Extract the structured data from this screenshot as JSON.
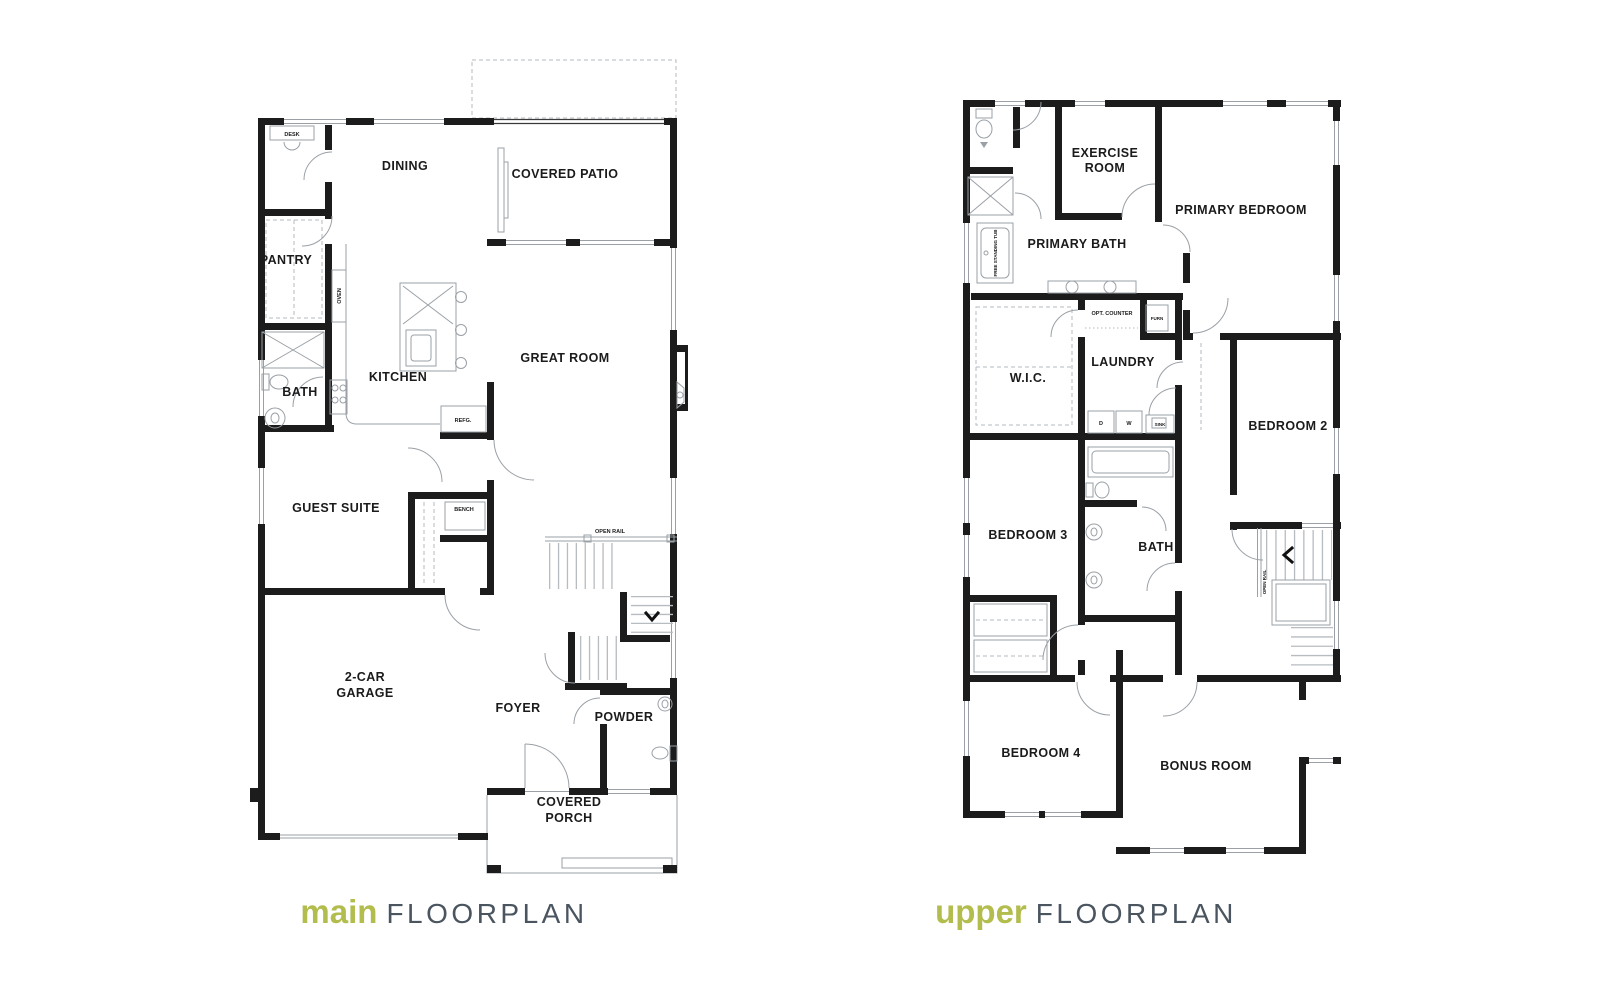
{
  "page": {
    "width": 1620,
    "height": 1000,
    "background": "#ffffff"
  },
  "colors": {
    "accent_green": "#b2bd4d",
    "title_gray": "#4a5560",
    "wall": "#1c1c1c",
    "fixture_gray": "#9aa0a6"
  },
  "titles": {
    "main": {
      "accent": "main",
      "rest": "FLOORPLAN"
    },
    "upper": {
      "accent": "upper",
      "rest": "FLOORPLAN"
    }
  },
  "main_floorplan": {
    "labels": {
      "desk": "DESK",
      "dining": "DINING",
      "covered_patio": "COVERED PATIO",
      "pantry": "PANTRY",
      "oven": "OVEN",
      "kitchen": "KITCHEN",
      "great_room": "GREAT ROOM",
      "bath": "BATH",
      "refg": "REFG.",
      "guest_suite": "GUEST SUITE",
      "bench": "BENCH",
      "open_rail": "OPEN RAIL",
      "garage_line1": "2-CAR",
      "garage_line2": "GARAGE",
      "foyer": "FOYER",
      "powder": "POWDER",
      "porch_line1": "COVERED",
      "porch_line2": "PORCH"
    }
  },
  "upper_floorplan": {
    "labels": {
      "exercise_line1": "EXERCISE",
      "exercise_line2": "ROOM",
      "primary_bedroom": "PRIMARY BEDROOM",
      "primary_bath": "PRIMARY BATH",
      "freestanding_tub": "FREE STANDING TUB",
      "opt_counter": "OPT. COUNTER",
      "furn": "FURN",
      "wic": "W.I.C.",
      "laundry": "LAUNDRY",
      "dryer": "D",
      "washer": "W",
      "sink": "SINK",
      "bedroom2": "BEDROOM 2",
      "bedroom3": "BEDROOM 3",
      "bath": "BATH",
      "open_rail": "OPEN RAIL",
      "bedroom4": "BEDROOM 4",
      "bonus_room": "BONUS ROOM"
    }
  }
}
